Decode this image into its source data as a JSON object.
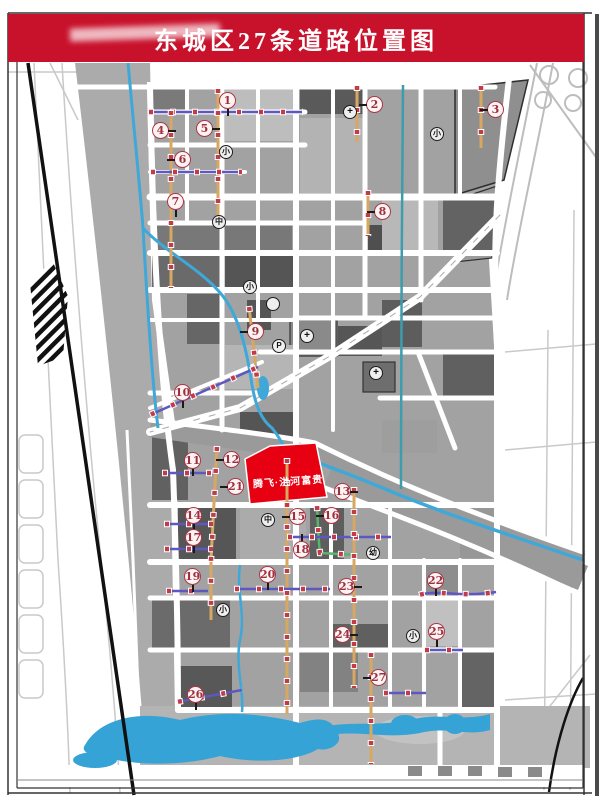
{
  "title": "东城区27条道路位置图",
  "parcel": {
    "label": "腾飞·洪河富贵",
    "color": "#e60012"
  },
  "legend_count": "27",
  "colors": {
    "banner_red": "#c8112b",
    "marker_ring": "#a83848",
    "water_blue": "#3fa8d8",
    "canal_teal": "#3d9dac",
    "road_orange": "#d8a761",
    "road_blue": "#5f57c0",
    "road_green": "#57b46a",
    "block_gray": "#a2a2a2"
  },
  "markers": [
    {
      "n": "1",
      "x": 228,
      "y": 101,
      "t": "down"
    },
    {
      "n": "2",
      "x": 375,
      "y": 105,
      "t": "left"
    },
    {
      "n": "3",
      "x": 496,
      "y": 110,
      "t": "left"
    },
    {
      "n": "4",
      "x": 161,
      "y": 131,
      "t": "right"
    },
    {
      "n": "5",
      "x": 205,
      "y": 129,
      "t": "right"
    },
    {
      "n": "6",
      "x": 183,
      "y": 160,
      "t": "left"
    },
    {
      "n": "7",
      "x": 176,
      "y": 202,
      "t": "down"
    },
    {
      "n": "8",
      "x": 383,
      "y": 212,
      "t": "left"
    },
    {
      "n": "9",
      "x": 256,
      "y": 332,
      "t": "left"
    },
    {
      "n": "10",
      "x": 183,
      "y": 393,
      "t": "down"
    },
    {
      "n": "11",
      "x": 193,
      "y": 461,
      "t": "down"
    },
    {
      "n": "12",
      "x": 232,
      "y": 460,
      "t": "left"
    },
    {
      "n": "13",
      "x": 343,
      "y": 492,
      "t": "right"
    },
    {
      "n": "14",
      "x": 194,
      "y": 516,
      "t": "down"
    },
    {
      "n": "15",
      "x": 298,
      "y": 517,
      "t": "left"
    },
    {
      "n": "16",
      "x": 332,
      "y": 516,
      "t": "left"
    },
    {
      "n": "17",
      "x": 194,
      "y": 538,
      "t": "down"
    },
    {
      "n": "18",
      "x": 302,
      "y": 550,
      "t": "up"
    },
    {
      "n": "19",
      "x": 193,
      "y": 577,
      "t": "down"
    },
    {
      "n": "20",
      "x": 268,
      "y": 575,
      "t": "down"
    },
    {
      "n": "21",
      "x": 236,
      "y": 487,
      "t": "left"
    },
    {
      "n": "22",
      "x": 436,
      "y": 581,
      "t": "down"
    },
    {
      "n": "23",
      "x": 347,
      "y": 587,
      "t": "right"
    },
    {
      "n": "24",
      "x": 343,
      "y": 635,
      "t": "right"
    },
    {
      "n": "25",
      "x": 437,
      "y": 632,
      "t": "down"
    },
    {
      "n": "26",
      "x": 196,
      "y": 695,
      "t": "down"
    },
    {
      "n": "27",
      "x": 379,
      "y": 678,
      "t": "left"
    }
  ],
  "pois": [
    {
      "g": "+",
      "name": "hospital-icon",
      "x": 350,
      "y": 112,
      "big": true
    },
    {
      "g": "+",
      "name": "hospital-icon",
      "x": 307,
      "y": 336,
      "big": true
    },
    {
      "g": "+",
      "name": "hospital-icon",
      "x": 376,
      "y": 373,
      "big": true
    },
    {
      "g": "小",
      "name": "elementary-school-icon",
      "x": 226,
      "y": 152,
      "big": false
    },
    {
      "g": "小",
      "name": "elementary-school-icon",
      "x": 437,
      "y": 134,
      "big": false
    },
    {
      "g": "小",
      "name": "elementary-school-icon",
      "x": 250,
      "y": 287,
      "big": false
    },
    {
      "g": "小",
      "name": "elementary-school-icon",
      "x": 223,
      "y": 610,
      "big": false
    },
    {
      "g": "小",
      "name": "elementary-school-icon",
      "x": 413,
      "y": 636,
      "big": false
    },
    {
      "g": "中",
      "name": "middle-school-icon",
      "x": 219,
      "y": 222,
      "big": false
    },
    {
      "g": "中",
      "name": "middle-school-icon",
      "x": 268,
      "y": 520,
      "big": false
    },
    {
      "g": "幼",
      "name": "kindergarten-icon",
      "x": 373,
      "y": 553,
      "big": false
    },
    {
      "g": "P",
      "name": "parking-icon",
      "x": 279,
      "y": 346,
      "big": false
    },
    {
      "g": "",
      "name": "landmark-icon",
      "x": 273,
      "y": 304,
      "big": false
    }
  ]
}
